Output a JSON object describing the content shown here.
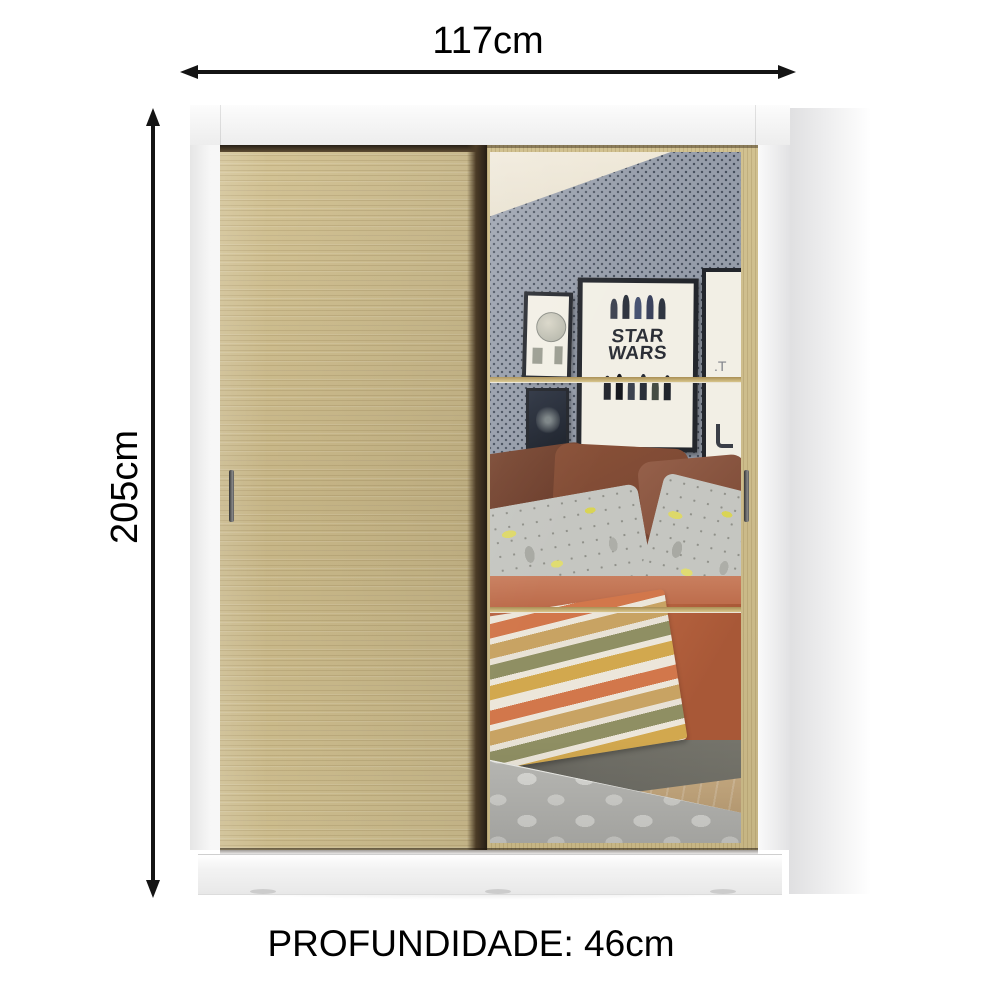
{
  "annotations": {
    "width_label": "117cm",
    "height_label": "205cm",
    "depth_label": "PROFUNDIDADE: 46cm",
    "arrow_color": "#141414",
    "text_color": "#000000"
  },
  "product": {
    "type": "wardrobe-two-sliding-doors-one-mirror",
    "frame_color": "#f2f2f2",
    "door_wood_color": "#cbbb8d",
    "door_edge_shadow_color": "#3a2d1d",
    "handle_color": "#4a4a4a",
    "base_color": "#f0f0f0"
  },
  "mirror_reflection": {
    "wallpaper_color": "#9299a6",
    "wallpaper_dot_color": "#424b59",
    "ceiling_color": "#ece4d1",
    "posters": {
      "star_wars_line1": "STAR",
      "star_wars_line2": "WARS",
      "right_poster_partial_text": ".T",
      "frame_color": "#23262c",
      "paper_color": "#f2efe5"
    },
    "bed": {
      "pillow_brown_colors": [
        "#6e4130",
        "#7e4c37",
        "#8a5640"
      ],
      "pillow_pattern_base_color": "#c5c6c1",
      "pillow_pattern_accent_color": "#ddd86a",
      "duvet_color": "#b4603e",
      "blanket_stripe_colors": [
        "#ece6da",
        "#d2774b",
        "#c8a363",
        "#8f8f63",
        "#d2a84e"
      ],
      "bed_base_color": "#6f6e66"
    },
    "floor_color": "#c3a67c",
    "rug_color": "#b9b9b5",
    "rug_dot_color": "#dadad6"
  }
}
